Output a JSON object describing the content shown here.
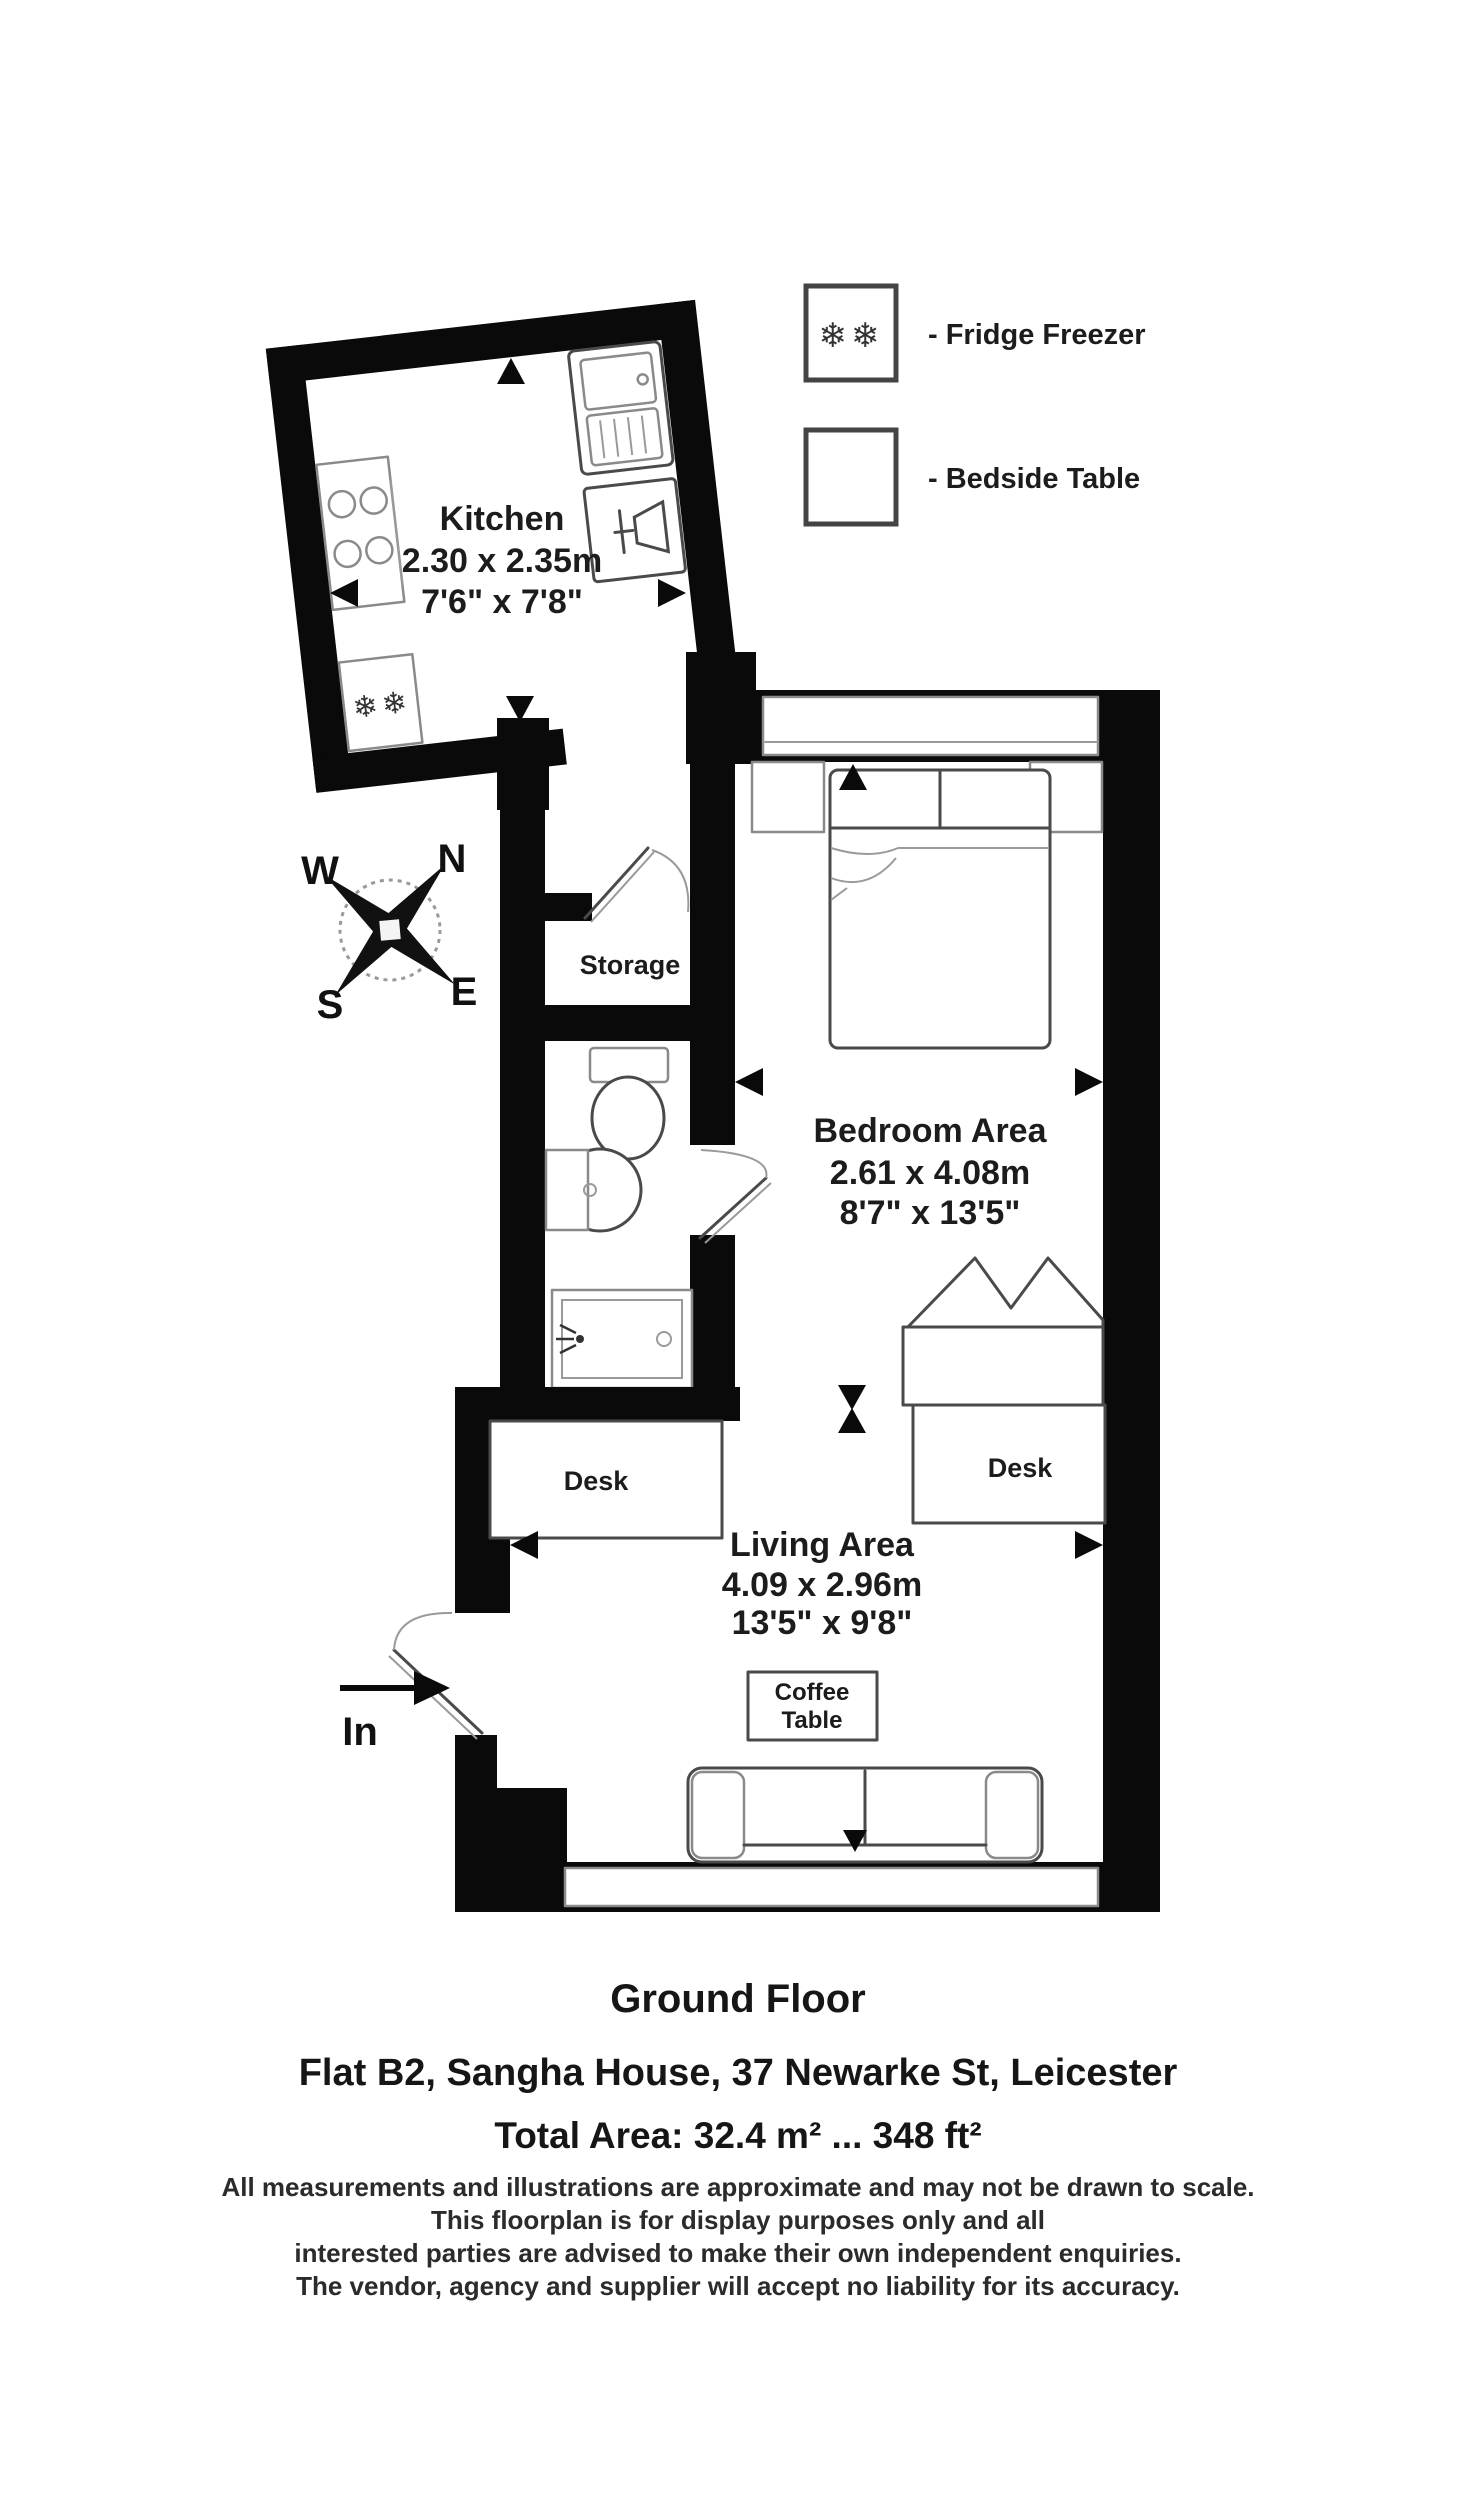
{
  "legend": {
    "fridge": {
      "symbol": "❄❄",
      "label": "- Fridge Freezer"
    },
    "bedside": {
      "label": "- Bedside Table"
    }
  },
  "compass": {
    "n": "N",
    "e": "E",
    "s": "S",
    "w": "W"
  },
  "kitchen": {
    "name": "Kitchen",
    "dim_m": "2.30 x 2.35m",
    "dim_ft": "7'6\" x 7'8\"",
    "fridge_symbol": "❄❄"
  },
  "storage": {
    "name": "Storage"
  },
  "bedroom": {
    "name": "Bedroom Area",
    "dim_m": "2.61 x 4.08m",
    "dim_ft": "8'7\" x 13'5\""
  },
  "living": {
    "name": "Living Area",
    "dim_m": "4.09 x 2.96m",
    "dim_ft": "13'5\" x 9'8\""
  },
  "furniture": {
    "desk_left": "Desk",
    "desk_right": "Desk",
    "coffee_line1": "Coffee",
    "coffee_line2": "Table"
  },
  "entrance": {
    "label": "In"
  },
  "footer": {
    "floor": "Ground Floor",
    "address": "Flat B2, Sangha House, 37 Newarke St, Leicester",
    "area": "Total Area: 32.4 m² ... 348 ft²",
    "disclaimer": [
      "All measurements and illustrations are approximate and may not be drawn to scale.",
      "This floorplan is for display purposes only and all",
      "interested parties are advised to make their own independent enquiries.",
      "The vendor, agency and supplier will accept no liability for its accuracy."
    ]
  }
}
